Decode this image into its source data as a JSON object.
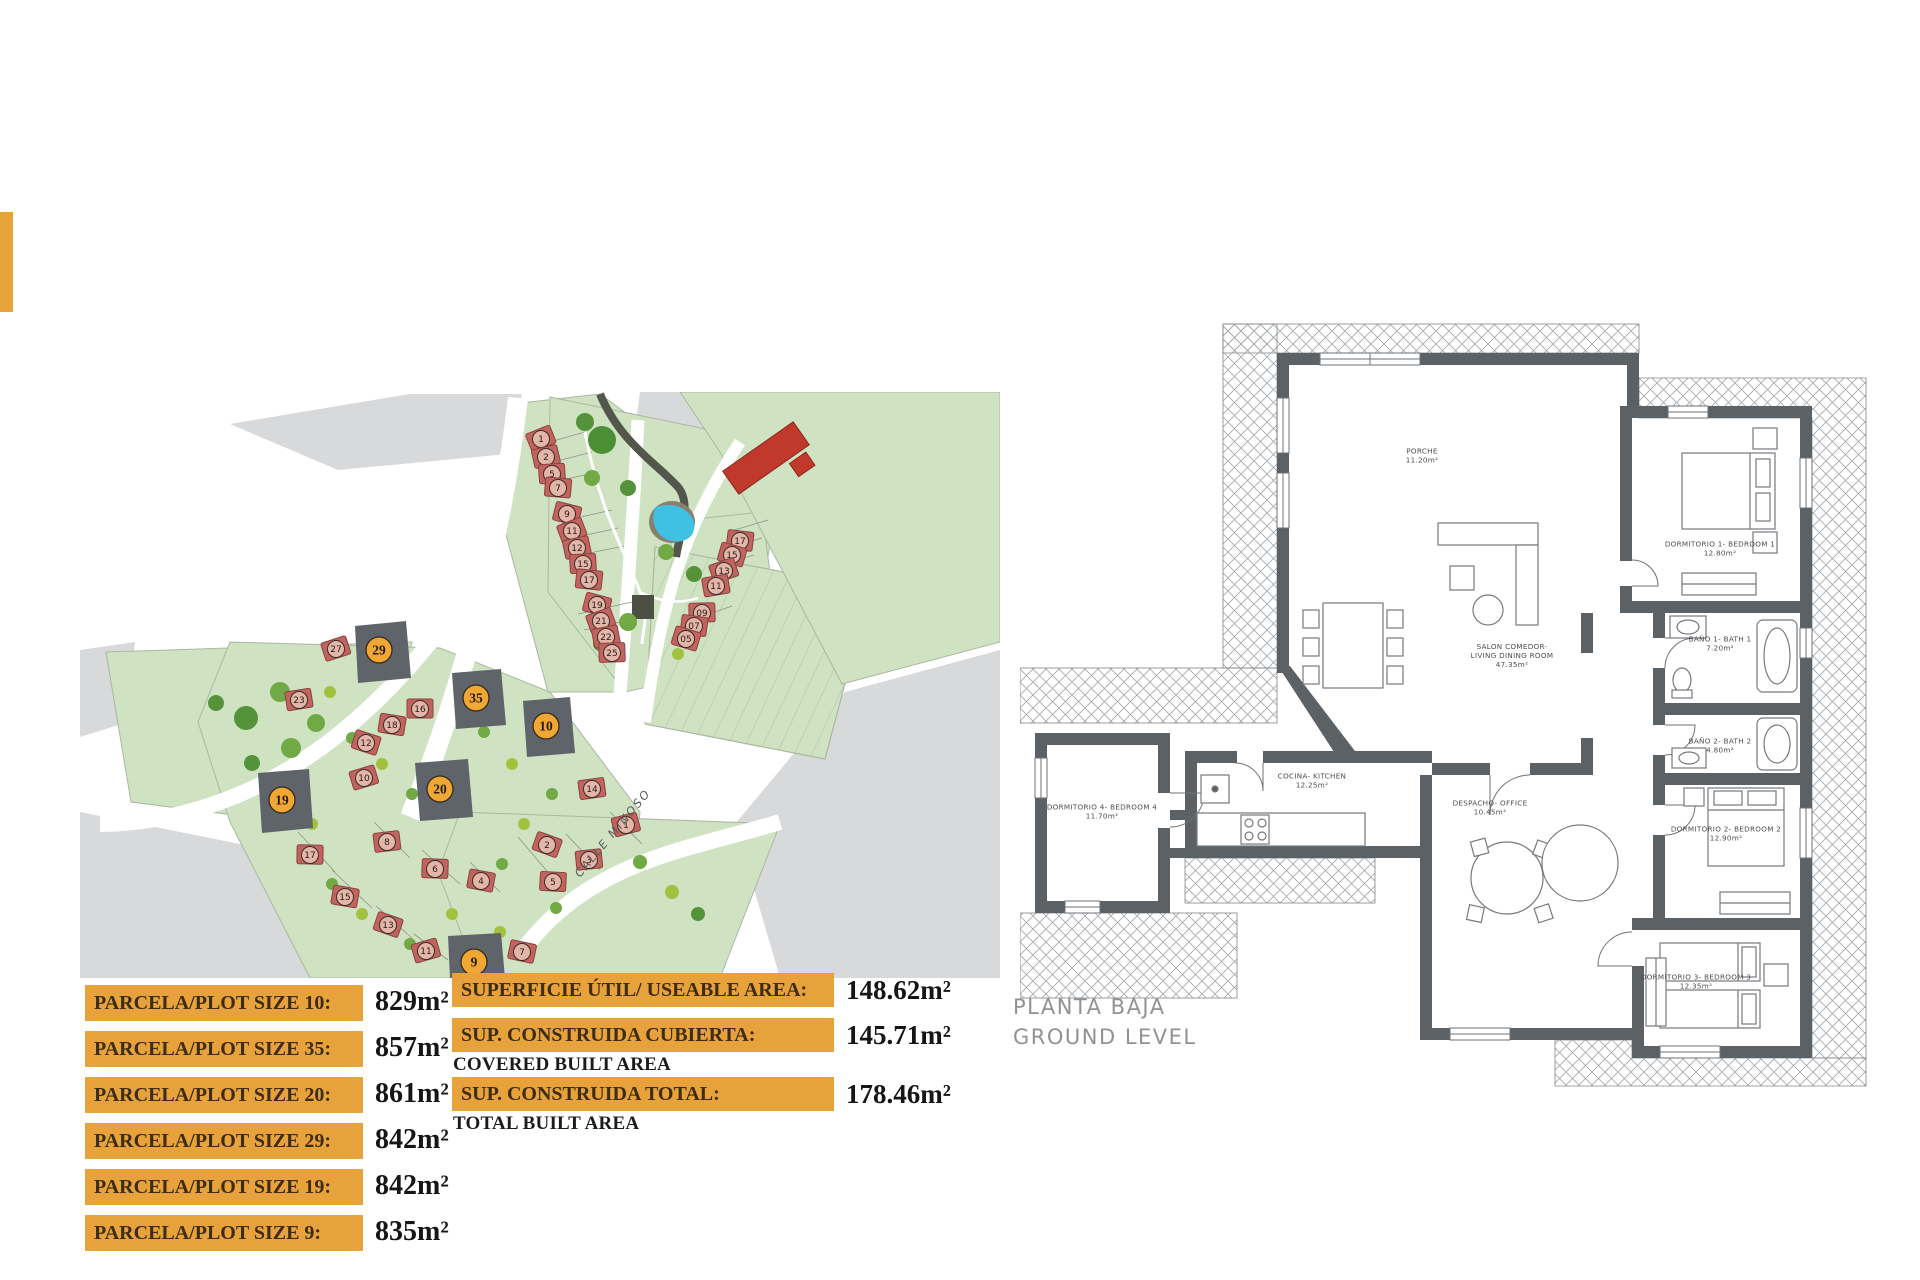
{
  "site_plan": {
    "street_label": "CALLE MINOSO",
    "colors": {
      "green": "#cfe2c2",
      "green_edge": "#a8b8a0",
      "gray": "#d8d9da",
      "house": "#c2635f",
      "house_edge": "#8a4340",
      "house_badge": "#e3b6a9",
      "dark_plot": "#5f646a",
      "badge": "#f0a733",
      "badge_edge": "#33291c",
      "pond": "#3fc1e3",
      "pond_rim": "#8a7f6d",
      "tree_dark": "#55933b",
      "tree_mid": "#71a945",
      "bush": "#a2c23f",
      "path_dark": "#53564a"
    },
    "highlighted_plots": [
      {
        "n": "29",
        "x": 299,
        "y": 258
      },
      {
        "n": "35",
        "x": 396,
        "y": 306
      },
      {
        "n": "10",
        "x": 466,
        "y": 334
      },
      {
        "n": "20",
        "x": 360,
        "y": 397
      },
      {
        "n": "19",
        "x": 202,
        "y": 408
      },
      {
        "n": "9",
        "x": 394,
        "y": 570
      }
    ],
    "houses": [
      {
        "n": "1",
        "x": 461,
        "y": 47
      },
      {
        "n": "2",
        "x": 466,
        "y": 65
      },
      {
        "n": "5",
        "x": 472,
        "y": 82
      },
      {
        "n": "7",
        "x": 478,
        "y": 96
      },
      {
        "n": "9",
        "x": 487,
        "y": 122
      },
      {
        "n": "11",
        "x": 492,
        "y": 139
      },
      {
        "n": "12",
        "x": 497,
        "y": 156
      },
      {
        "n": "15",
        "x": 503,
        "y": 172
      },
      {
        "n": "17",
        "x": 509,
        "y": 188
      },
      {
        "n": "19",
        "x": 517,
        "y": 213
      },
      {
        "n": "21",
        "x": 521,
        "y": 229
      },
      {
        "n": "22",
        "x": 526,
        "y": 245
      },
      {
        "n": "25",
        "x": 532,
        "y": 261
      },
      {
        "n": "17",
        "x": 660,
        "y": 149
      },
      {
        "n": "15",
        "x": 652,
        "y": 163
      },
      {
        "n": "13",
        "x": 644,
        "y": 179
      },
      {
        "n": "11",
        "x": 636,
        "y": 194
      },
      {
        "n": "09",
        "x": 622,
        "y": 221
      },
      {
        "n": "07",
        "x": 614,
        "y": 234
      },
      {
        "n": "05",
        "x": 606,
        "y": 247
      },
      {
        "n": "27",
        "x": 256,
        "y": 257
      },
      {
        "n": "23",
        "x": 219,
        "y": 308
      },
      {
        "n": "16",
        "x": 340,
        "y": 317
      },
      {
        "n": "18",
        "x": 312,
        "y": 333
      },
      {
        "n": "12",
        "x": 286,
        "y": 351
      },
      {
        "n": "10",
        "x": 284,
        "y": 386
      },
      {
        "n": "14",
        "x": 512,
        "y": 397
      },
      {
        "n": "17",
        "x": 230,
        "y": 463
      },
      {
        "n": "15",
        "x": 265,
        "y": 505
      },
      {
        "n": "13",
        "x": 308,
        "y": 533
      },
      {
        "n": "11",
        "x": 346,
        "y": 559
      },
      {
        "n": "8",
        "x": 307,
        "y": 450
      },
      {
        "n": "6",
        "x": 355,
        "y": 477
      },
      {
        "n": "4",
        "x": 401,
        "y": 489
      },
      {
        "n": "2",
        "x": 467,
        "y": 453
      },
      {
        "n": "1",
        "x": 546,
        "y": 433
      },
      {
        "n": "3",
        "x": 509,
        "y": 468
      },
      {
        "n": "5",
        "x": 473,
        "y": 490
      },
      {
        "n": "7",
        "x": 442,
        "y": 560
      }
    ]
  },
  "legend": {
    "parcels": [
      {
        "label": "PARCELA/PLOT SIZE 10:",
        "value": "829m²"
      },
      {
        "label": "PARCELA/PLOT SIZE 35:",
        "value": "857m²"
      },
      {
        "label": "PARCELA/PLOT SIZE 20:",
        "value": "861m²"
      },
      {
        "label": "PARCELA/PLOT SIZE 29:",
        "value": "842m²"
      },
      {
        "label": "PARCELA/PLOT SIZE 19:",
        "value": "842m²"
      },
      {
        "label": "PARCELA/PLOT SIZE 9:",
        "value": "835m²"
      }
    ],
    "areas": [
      {
        "label": "SUPERFICIE ÚTIL/ USEABLE AREA:",
        "sublabel": "",
        "value": "148.62m²"
      },
      {
        "label": "SUP. CONSTRUIDA CUBIERTA:",
        "sublabel": "COVERED BUILT AREA",
        "value": "145.71m²"
      },
      {
        "label": "SUP. CONSTRUIDA TOTAL:",
        "sublabel": "TOTAL BUILT AREA",
        "value": "178.46m²"
      }
    ]
  },
  "floor_plan": {
    "title_line1": "PLANTA BAJA",
    "title_line2": "GROUND LEVEL",
    "wall_color": "#5c6166",
    "hatch_color": "#a6abaf",
    "furniture_color": "#75797d",
    "label_color": "#4c4c4c",
    "rooms": [
      {
        "lines": [
          "PORCHE",
          "11.20m²"
        ],
        "x": 402,
        "y": 140
      },
      {
        "lines": [
          "SALON COMEDOR-",
          "LIVING DINING ROOM",
          "47.35m²"
        ],
        "x": 492,
        "y": 340
      },
      {
        "lines": [
          "COCINA- KITCHEN",
          "12.25m²"
        ],
        "x": 292,
        "y": 465
      },
      {
        "lines": [
          "DORMITORIO 4- BEDROOM 4",
          "11.70m²"
        ],
        "x": 82,
        "y": 496
      },
      {
        "lines": [
          "DESPACHO- OFFICE",
          "10.45m²"
        ],
        "x": 470,
        "y": 492
      },
      {
        "lines": [
          "DORMITORIO 1- BEDROOM 1",
          "12.80m²"
        ],
        "x": 700,
        "y": 233
      },
      {
        "lines": [
          "BAÑO 1- BATH 1",
          "7.20m²"
        ],
        "x": 700,
        "y": 328
      },
      {
        "lines": [
          "BAÑO 2- BATH 2",
          "4.80m²"
        ],
        "x": 700,
        "y": 430
      },
      {
        "lines": [
          "DORMITORIO 2- BEDROOM 2",
          "12.90m²"
        ],
        "x": 706,
        "y": 518
      },
      {
        "lines": [
          "DORMITORIO 3- BEDROOM 3",
          "12.35m²"
        ],
        "x": 676,
        "y": 666
      }
    ]
  }
}
